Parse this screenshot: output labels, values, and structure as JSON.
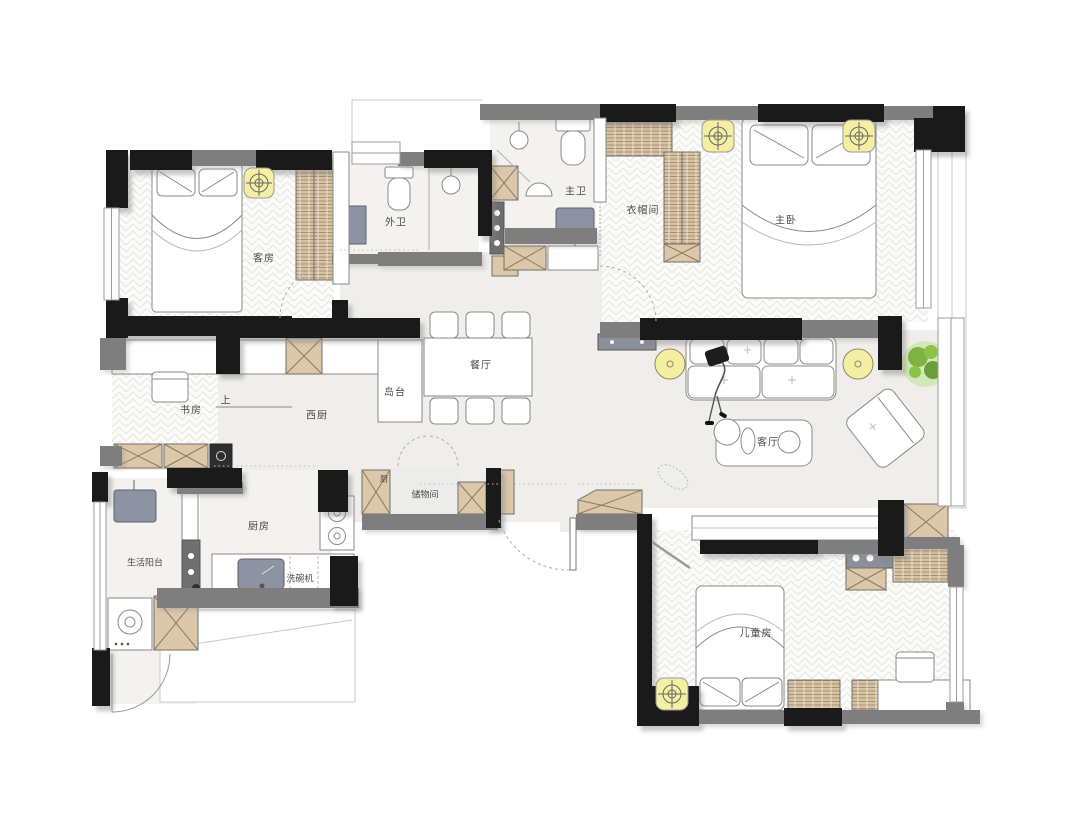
{
  "title": "apartment-floor-plan",
  "colors": {
    "wall_black": "#1a1a1a",
    "wall_grey": "#7e7e7e",
    "floor_main": "#efeeea",
    "floor_light": "#f3f2ee",
    "cabinet_tan": "#dcc7a8",
    "light_yellow": "#f5efa3",
    "fixture_grey": "#8d93a2",
    "plant_green": "#7cb342",
    "line_grey": "#9a9a9a"
  },
  "rooms": [
    {
      "id": "guest-room",
      "label": "客房"
    },
    {
      "id": "guest-bathroom",
      "label": "外卫"
    },
    {
      "id": "master-bathroom",
      "label": "主卫"
    },
    {
      "id": "walk-in-closet",
      "label": "衣帽间"
    },
    {
      "id": "master-bedroom",
      "label": "主卧"
    },
    {
      "id": "dining-room",
      "label": "餐厅"
    },
    {
      "id": "island-counter",
      "label": "岛台"
    },
    {
      "id": "study",
      "label": "书房"
    },
    {
      "id": "step-up",
      "label": "上"
    },
    {
      "id": "western-kitchen",
      "label": "西厨"
    },
    {
      "id": "living-room",
      "label": "客厅"
    },
    {
      "id": "kitchen",
      "label": "厨房"
    },
    {
      "id": "dishwasher",
      "label": "洗碗机"
    },
    {
      "id": "utility-balcony",
      "label": "生活阳台"
    },
    {
      "id": "pantry",
      "label": "厨"
    },
    {
      "id": "storage-room",
      "label": "储物间"
    },
    {
      "id": "kids-room",
      "label": "儿童房"
    }
  ],
  "icons": [
    "double-bed",
    "wardrobe",
    "ceiling-light",
    "toilet",
    "shower-head",
    "washbasin",
    "sliding-door",
    "dining-table",
    "dining-chair",
    "kitchen-island",
    "counter",
    "gas-stove",
    "kitchen-sink",
    "washing-machine",
    "sofa",
    "person",
    "floor-lamp",
    "potted-plant",
    "coffee-table",
    "lounge-chair",
    "pet-toy",
    "desk",
    "desk-chair",
    "entry-door",
    "window",
    "door-swing",
    "shoe-cabinet",
    "storage-cabinet"
  ]
}
